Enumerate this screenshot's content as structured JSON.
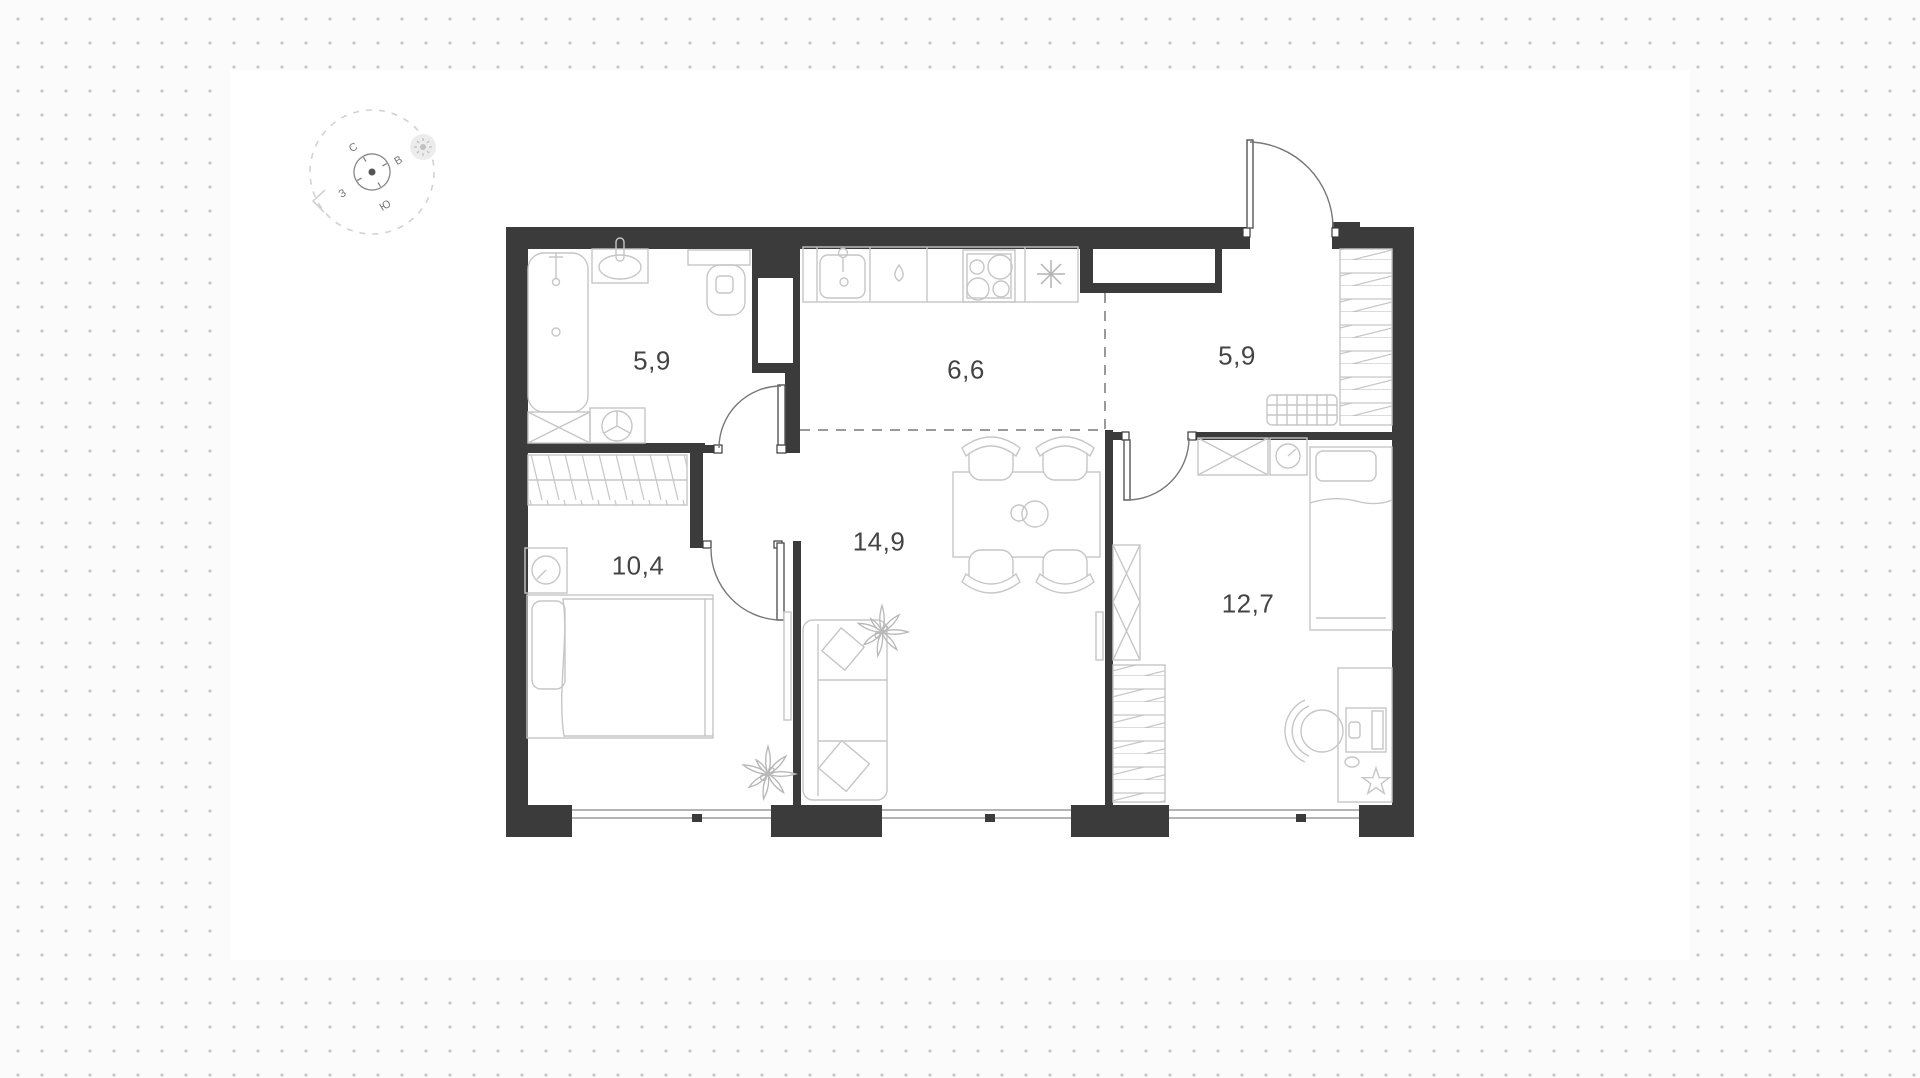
{
  "document": {
    "type": "apartment-floor-plan",
    "sheet_color": "#ffffff",
    "background_dot_color": "#c9c9c9"
  },
  "compass": {
    "north": "С",
    "east": "В",
    "south": "Ю",
    "west": "З"
  },
  "rooms": [
    {
      "name": "bathroom",
      "area": "5,9"
    },
    {
      "name": "kitchen",
      "area": "6,6"
    },
    {
      "name": "entrance-hall",
      "area": "5,9"
    },
    {
      "name": "bedroom",
      "area": "10,4"
    },
    {
      "name": "living-room",
      "area": "14,9"
    },
    {
      "name": "bedroom-2",
      "area": "12,7"
    }
  ],
  "colors": {
    "wall": "#3b3b3b",
    "furniture_outline": "#c6c6c6",
    "zone_dash": "#9a9a9a",
    "label_text": "#444444"
  }
}
